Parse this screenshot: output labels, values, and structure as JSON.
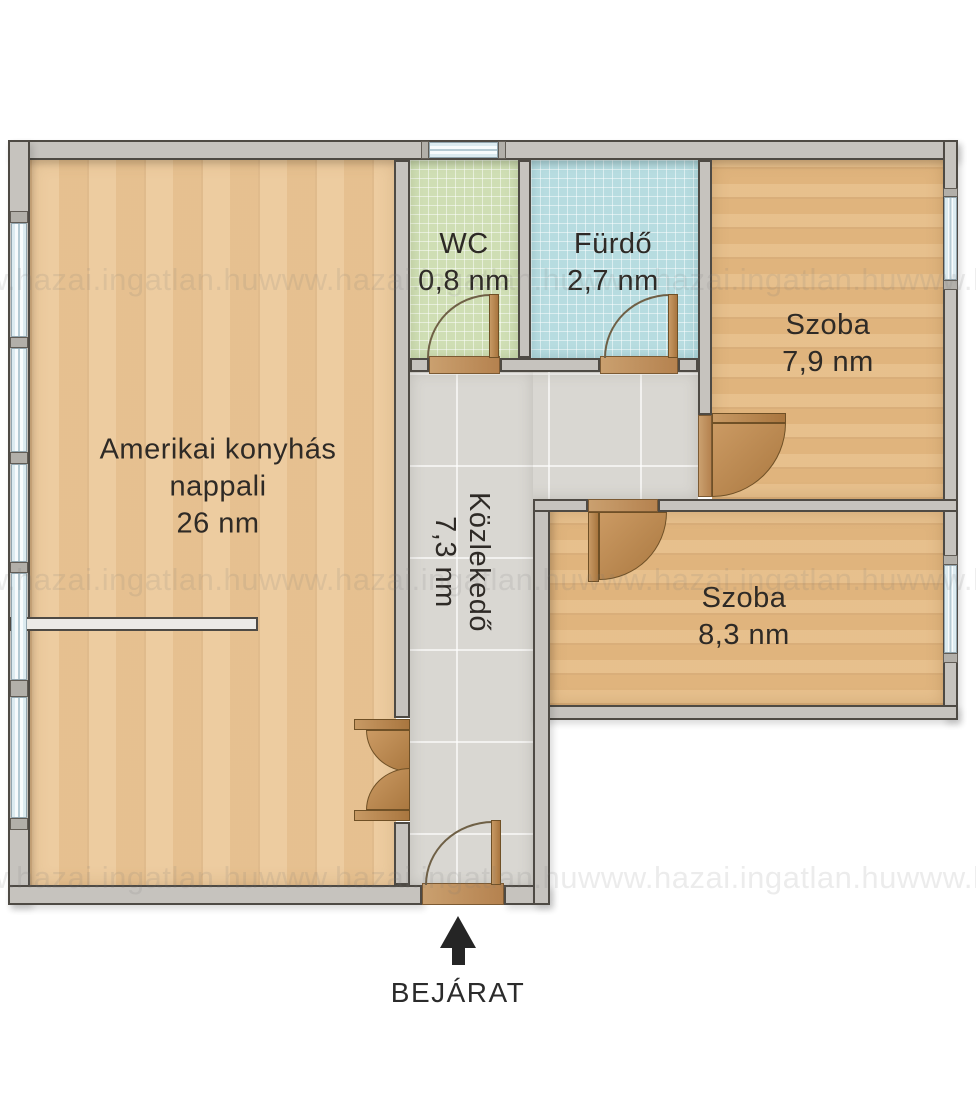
{
  "watermark_text": "www.hazai.ingatlan.huwww.hazai.ingatlan.huwww.hazai.ingatlan.huwww.hazai.ingatlan.hu",
  "rooms": {
    "nappali": {
      "name_line1": "Amerikai konyhás",
      "name_line2": "nappali",
      "area": "26 nm"
    },
    "wc": {
      "name": "WC",
      "area": "0,8 nm"
    },
    "furdo": {
      "name": "Fürdő",
      "area": "2,7 nm"
    },
    "szoba79": {
      "name": "Szoba",
      "area": "7,9 nm"
    },
    "szoba83": {
      "name": "Szoba",
      "area": "8,3 nm"
    },
    "kozlekedo": {
      "name": "Közlekedő",
      "area": "7,3 nm"
    }
  },
  "entrance": {
    "label": "BEJÁRAT"
  },
  "colors": {
    "wood_living": "#ecc898",
    "wood_room": "#e5bb84",
    "tile_wc": "#cfdeb4",
    "tile_bath": "#b7dce0",
    "tile_hall": "#d9d7d2",
    "wall": "#c6c3be",
    "wall_outline": "#4e4a44",
    "door_wood": "#b5824f",
    "window_frame": "#93a6af",
    "label_text": "#2e2a26"
  }
}
